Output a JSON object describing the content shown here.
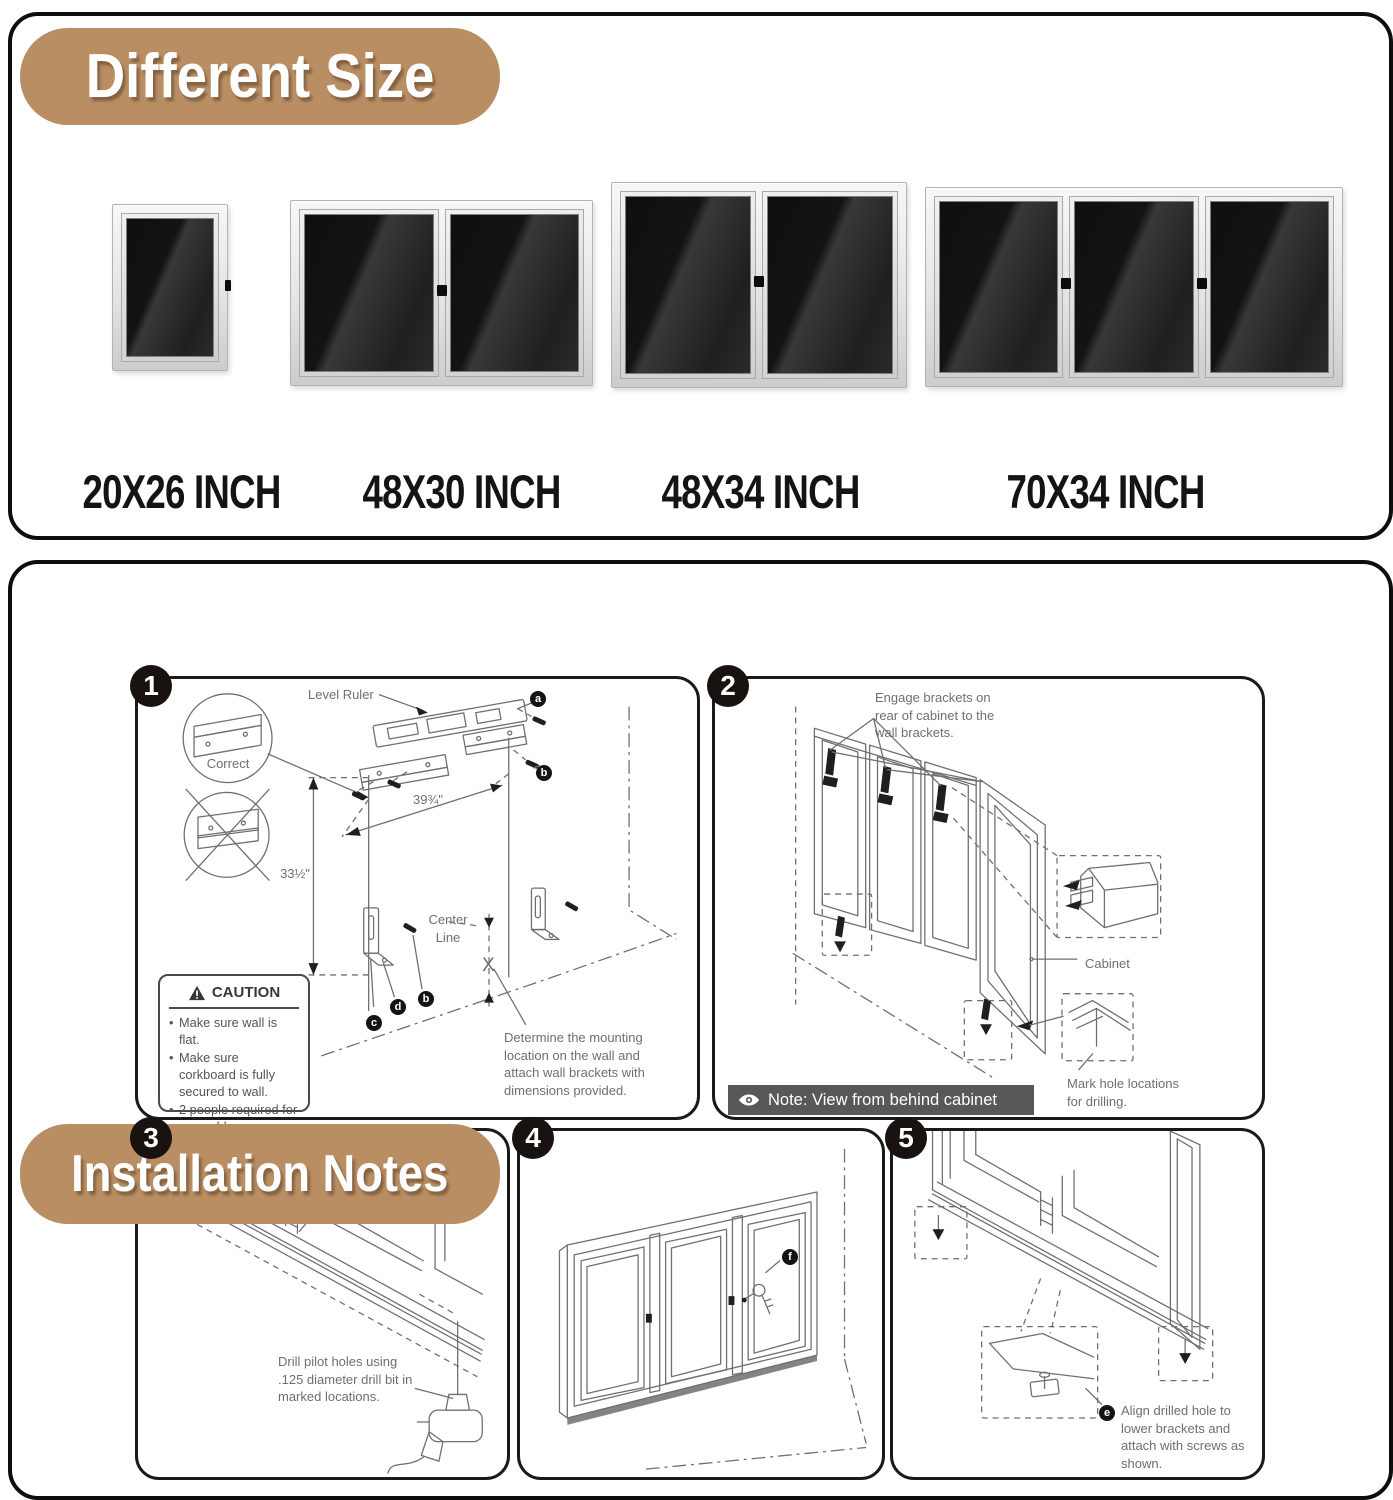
{
  "colors": {
    "accent_tan": "#b98e63",
    "panel_border": "#0d0d0d",
    "diagram_line": "#6f6f6f",
    "note_bar": "#57585a",
    "board_dark": "#1a1a1a"
  },
  "different_size": {
    "title": "Different Size",
    "sizes": [
      "20X26 INCH",
      "48X30 INCH",
      "48X34 INCH",
      "70X34 INCH"
    ]
  },
  "installation": {
    "title": "Installation Notes",
    "step1": {
      "number": "1",
      "level_ruler": "Level Ruler",
      "correct": "Correct",
      "dim_width": "39¾\"",
      "dim_height": "33½\"",
      "center_line": "Center Line",
      "x_mark": "X",
      "marker_a": "a",
      "marker_b": "b",
      "marker_b2": "b",
      "marker_c": "c",
      "marker_d": "d",
      "caution": {
        "title": "CAUTION",
        "items": [
          "Make sure wall is flat.",
          "Make sure corkboard is fully secured to wall.",
          "2 people required for assembly."
        ]
      },
      "note": "Determine the mounting location on the wall and attach wall brackets with dimensions provided."
    },
    "step2": {
      "number": "2",
      "engage_note": "Engage brackets on rear of cabinet to the wall brackets.",
      "cabinet_label": "Cabinet",
      "mark_note": "Mark hole locations for drilling.",
      "view_note": "Note: View from behind cabinet"
    },
    "step3": {
      "number": "3",
      "drill_note": "Drill pilot holes using .125 diameter drill bit in marked locations."
    },
    "step4": {
      "number": "4",
      "marker_f": "f"
    },
    "step5": {
      "number": "5",
      "marker_e": "e",
      "align_note": "Align drilled hole to lower brackets and attach with screws as shown."
    }
  }
}
